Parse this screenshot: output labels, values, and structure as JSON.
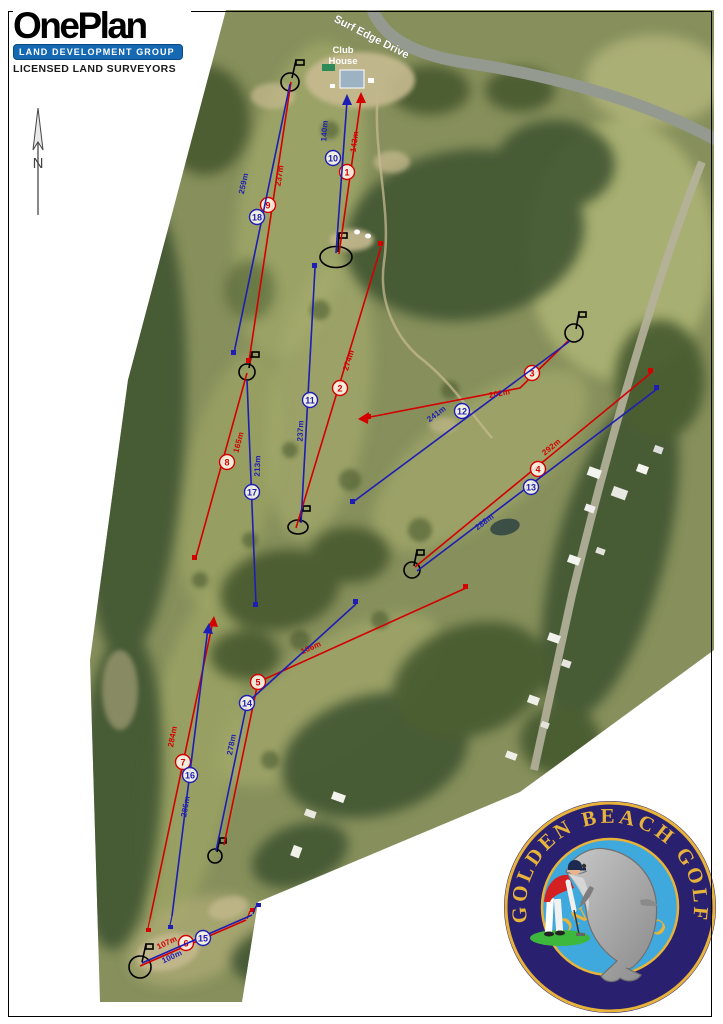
{
  "branding": {
    "oneplan": {
      "name": "OnePlan",
      "tagline_bar": "LAND DEVELOPMENT GROUP",
      "subtitle": "LICENSED LAND SURVEYORS",
      "bar_color": "#1569b3"
    },
    "club_logo": {
      "text_top": "GOLDEN BEACH GOLF",
      "text_bottom": "CLUB INC",
      "ring_color": "#2a2070",
      "gold_color": "#e7b33a",
      "sea_color": "#3fa8dc"
    }
  },
  "map": {
    "labels": {
      "road": "Surf Edge Drive",
      "clubhouse_line1": "Club",
      "clubhouse_line2": "House"
    },
    "north_label": "N",
    "colors": {
      "red_course": "#d40000",
      "blue_course": "#1e1eb4",
      "green_symbol": "#000000"
    }
  },
  "holes": [
    {
      "number": "1",
      "distance": "143m",
      "color": "red"
    },
    {
      "number": "2",
      "distance": "274m",
      "color": "red"
    },
    {
      "number": "3",
      "distance": "202m",
      "color": "red"
    },
    {
      "number": "4",
      "distance": "292m",
      "color": "red"
    },
    {
      "number": "5",
      "distance": "166m",
      "color": "red"
    },
    {
      "number": "6",
      "distance": "107m",
      "color": "red"
    },
    {
      "number": "7",
      "distance": "284m",
      "color": "red"
    },
    {
      "number": "8",
      "distance": "165m",
      "color": "red"
    },
    {
      "number": "9",
      "distance": "237m",
      "color": "red"
    },
    {
      "number": "10",
      "distance": "140m",
      "color": "blue"
    },
    {
      "number": "11",
      "distance": "237m",
      "color": "blue"
    },
    {
      "number": "12",
      "distance": "241m",
      "color": "blue"
    },
    {
      "number": "13",
      "distance": "288m",
      "color": "blue"
    },
    {
      "number": "14",
      "distance": "278m",
      "color": "blue"
    },
    {
      "number": "15",
      "distance": "100m",
      "color": "blue"
    },
    {
      "number": "16",
      "distance": "286m",
      "color": "blue"
    },
    {
      "number": "17",
      "distance": "213m",
      "color": "blue"
    },
    {
      "number": "18",
      "distance": "259m",
      "color": "blue"
    }
  ]
}
